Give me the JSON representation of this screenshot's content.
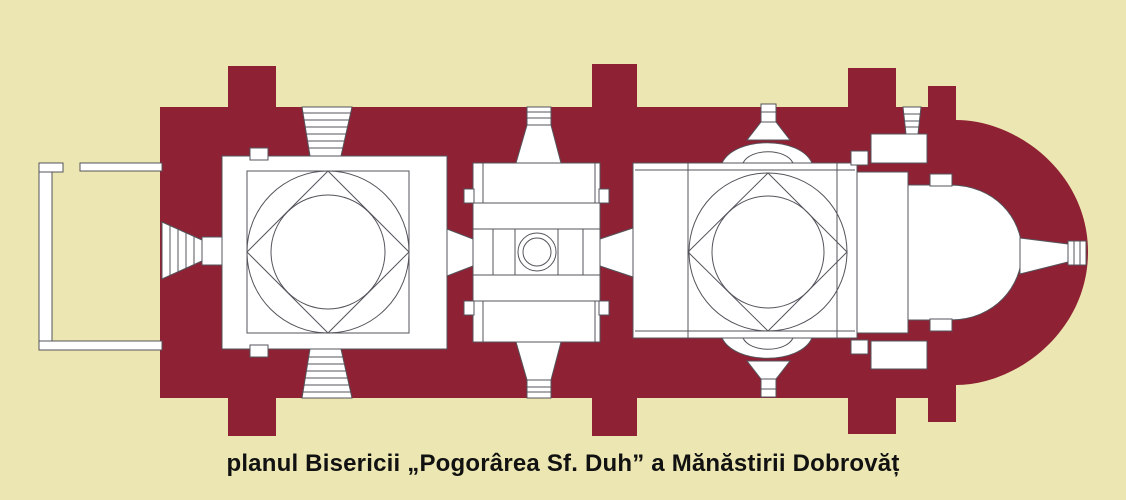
{
  "caption": "planul Bisericii „Pogorârea Sf. Duh” a Mănăstirii Dobrovăț",
  "colors": {
    "background": "#ece7b2",
    "wall": "#8e2133",
    "outline": "#55535b",
    "interior": "#ffffff",
    "caption_text": "#111111"
  }
}
